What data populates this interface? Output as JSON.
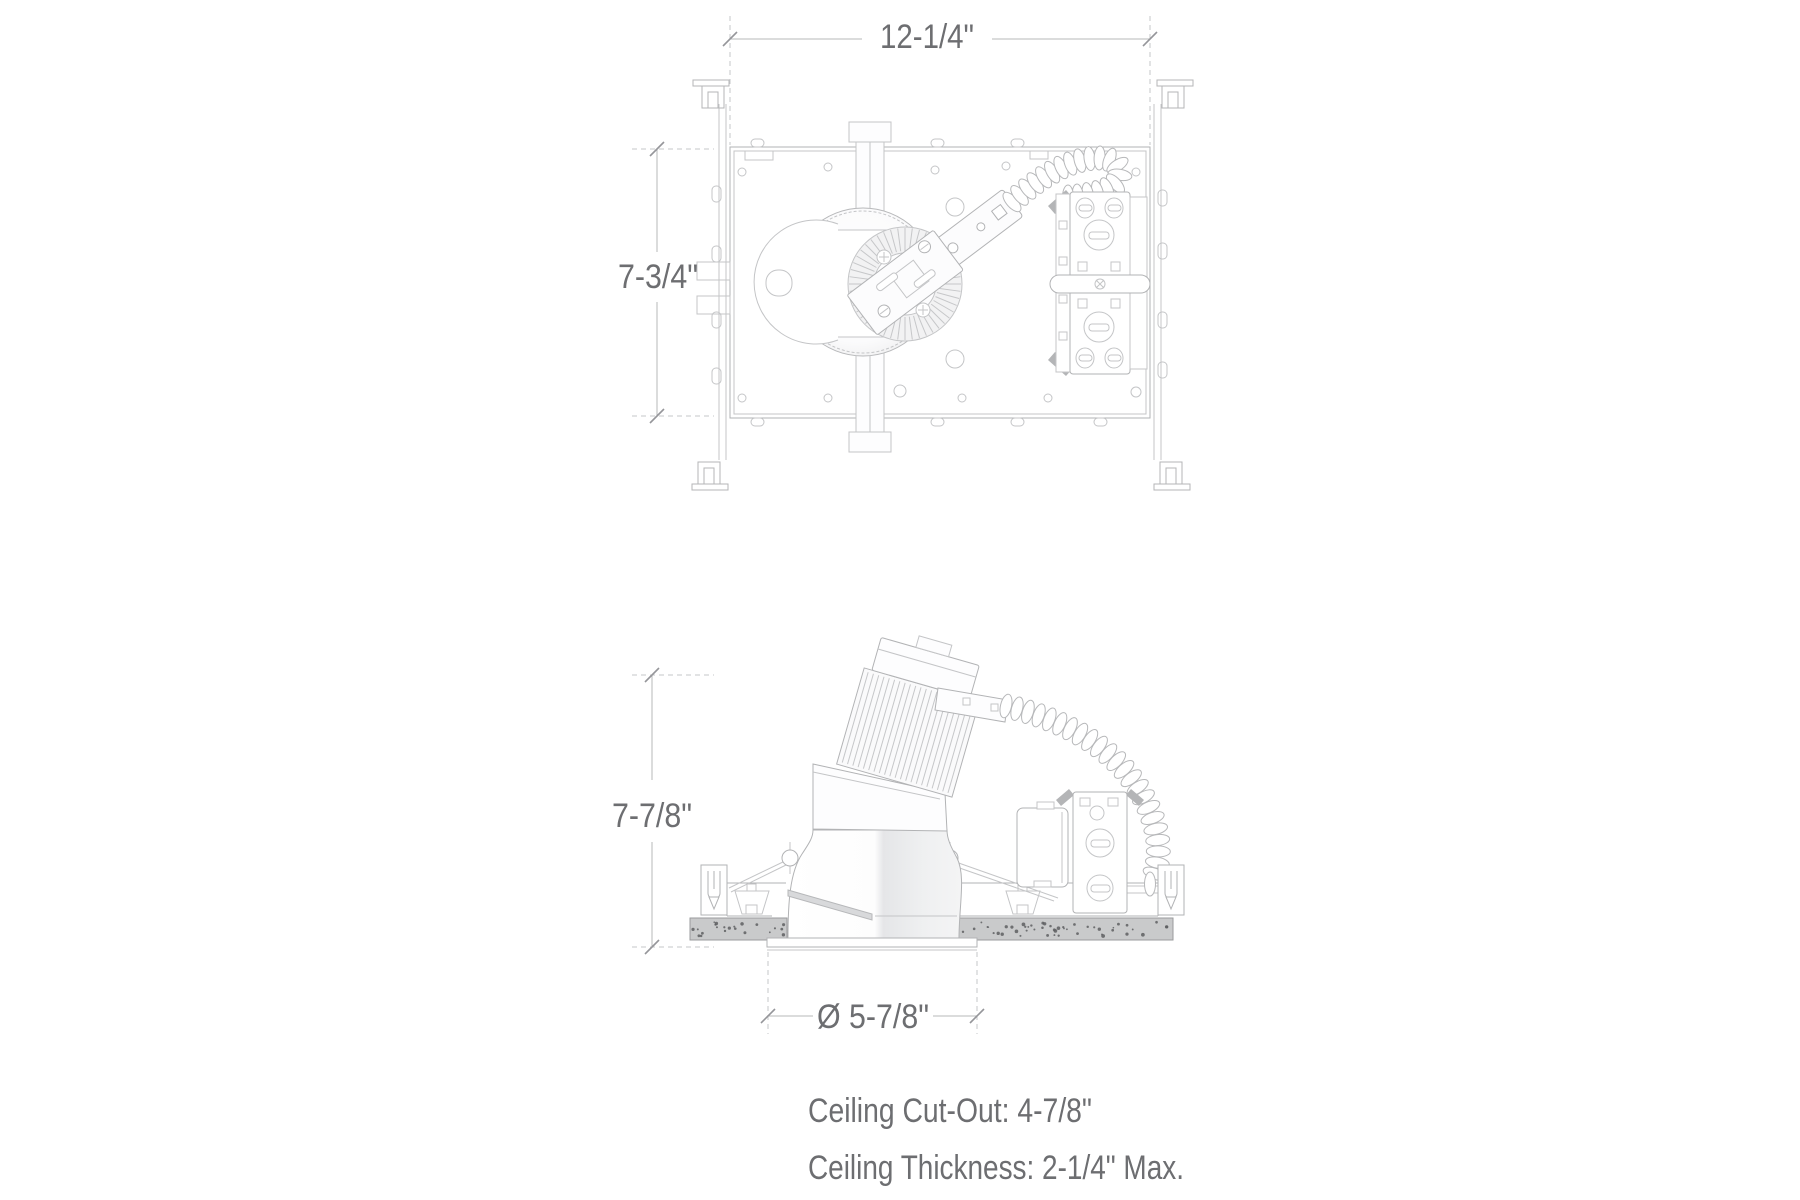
{
  "dimensions": {
    "plate_width": "12-1/4\"",
    "plate_depth": "7-3/4\"",
    "housing_height": "7-7/8\"",
    "trim_diameter": "Ø 5-7/8\""
  },
  "notes": {
    "ceiling_cutout": "Ceiling Cut-Out: 4-7/8\"",
    "ceiling_thickness": "Ceiling Thickness: 2-1/4\" Max."
  },
  "colors": {
    "line_light": "#c9cacc",
    "line_medium": "#aeafb1",
    "dimension_text": "#6d6e71",
    "ceiling_fill": "#c8c9cb",
    "speckle": "#5e5f62",
    "background": "#ffffff"
  }
}
